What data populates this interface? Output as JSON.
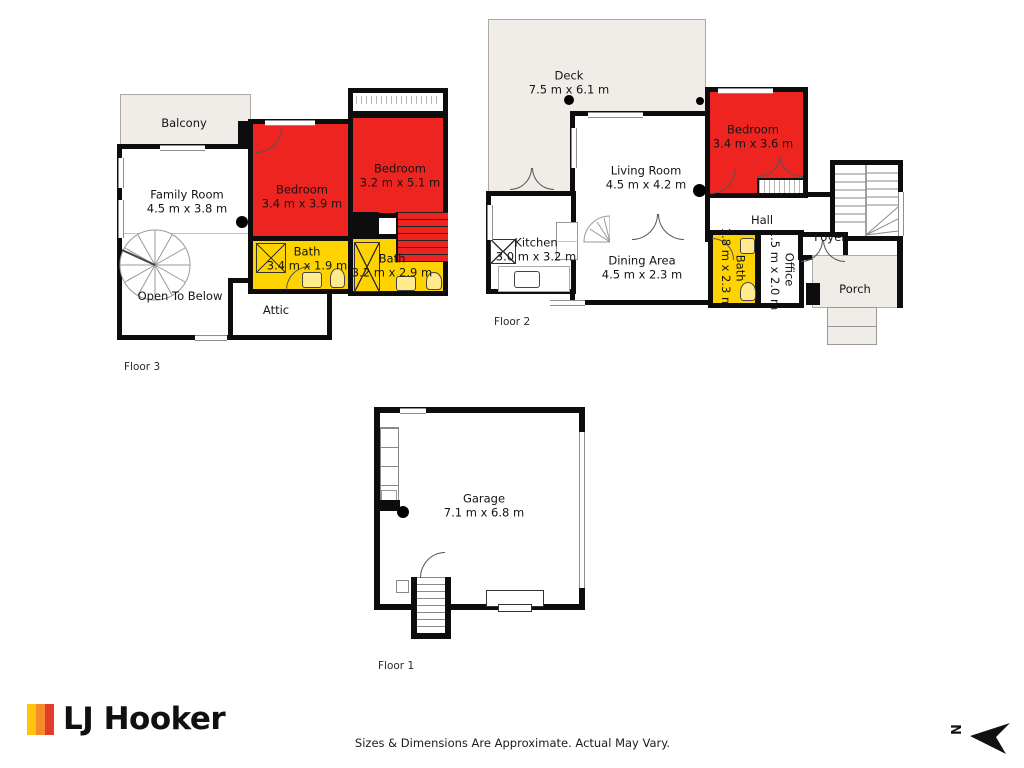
{
  "colors": {
    "bedroom_fill": "#ee2420",
    "bath_fill": "#ffd300",
    "outdoor_fill": "#f0ede8",
    "wall": "#0d0d0d",
    "logo_yellow": "#ffc40c",
    "logo_orange": "#f68b2a",
    "logo_red": "#e23d28"
  },
  "floors": [
    {
      "name": "Floor 3",
      "rooms": [
        {
          "label": "Balcony",
          "dims": ""
        },
        {
          "label": "Family Room",
          "dims": "4.5 m x 3.8 m"
        },
        {
          "label": "Bedroom",
          "dims": "3.4 m x 3.9 m"
        },
        {
          "label": "Bedroom",
          "dims": "3.2 m x 5.1 m"
        },
        {
          "label": "Bath",
          "dims": "3.4 m x 1.9 m"
        },
        {
          "label": "Bath",
          "dims": "3.2 m x 2.9 m"
        },
        {
          "label": "Open To Below",
          "dims": ""
        },
        {
          "label": "Attic",
          "dims": ""
        }
      ]
    },
    {
      "name": "Floor 2",
      "rooms": [
        {
          "label": "Deck",
          "dims": "7.5 m x 6.1 m"
        },
        {
          "label": "Living Room",
          "dims": "4.5 m x 4.2 m"
        },
        {
          "label": "Bedroom",
          "dims": "3.4 m x 3.6 m"
        },
        {
          "label": "Kitchen",
          "dims": "3.0 m x 3.2 m"
        },
        {
          "label": "Dining Area",
          "dims": "4.5 m x 2.3 m"
        },
        {
          "label": "Hall",
          "dims": ""
        },
        {
          "label": "Bath",
          "dims": "1.8 m x 2.3 m"
        },
        {
          "label": "Office",
          "dims": "1.5 m x 2.0 m"
        },
        {
          "label": "Foyer",
          "dims": ""
        },
        {
          "label": "Porch",
          "dims": ""
        }
      ]
    },
    {
      "name": "Floor 1",
      "rooms": [
        {
          "label": "Garage",
          "dims": "7.1 m x 6.8 m"
        }
      ]
    }
  ],
  "footer": {
    "brand": "LJ Hooker",
    "disclaimer": "Sizes & Dimensions Are Approximate. Actual May Vary.",
    "compass_letter": "N"
  }
}
